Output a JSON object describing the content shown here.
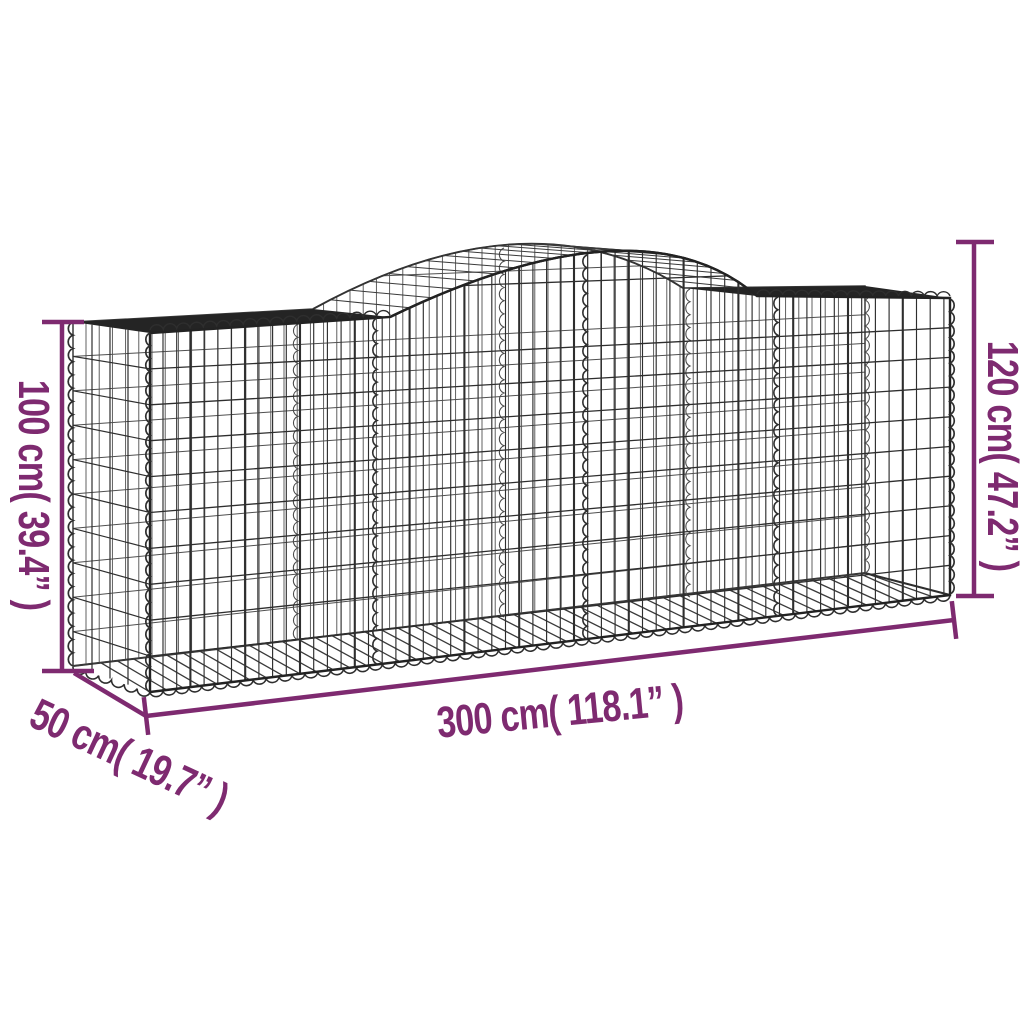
{
  "diagram": {
    "subject": "arched gabion basket wireframe drawing",
    "compartments": 4,
    "colors": {
      "background": "#ffffff",
      "accent": "#7e2a70",
      "wire": "#2e2e2e",
      "wire_light": "#4f4f4f",
      "band": "#242424",
      "hatch": "#3a3a3a"
    }
  },
  "dimensions": {
    "height_left": "100 cm( 39.4” )",
    "height_right": "120 cm( 47.2” )",
    "length": "300 cm( 118.1” )",
    "depth": "50 cm( 19.7” )"
  }
}
